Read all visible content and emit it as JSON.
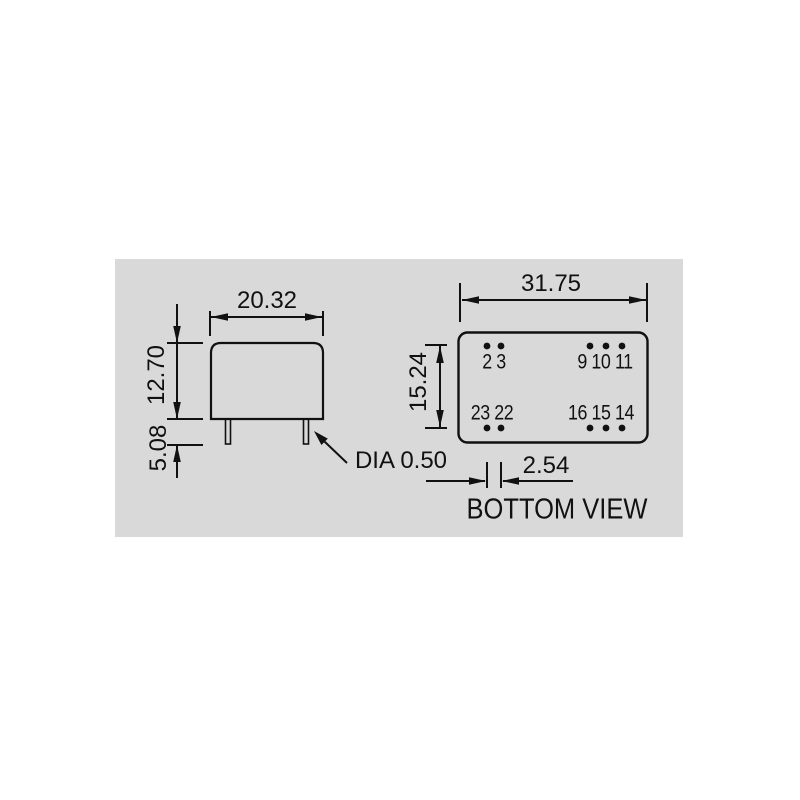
{
  "drawing": {
    "kind": "mechanical-dimension-drawing",
    "units_implied": "mm",
    "colors": {
      "panel_bg": "#d9d9d9",
      "line": "#111111"
    }
  },
  "side_view": {
    "width": "20.32",
    "height": "12.70",
    "pin_length": "5.08",
    "pin_diameter": "DIA 0.50"
  },
  "bottom_view": {
    "width": "31.75",
    "row_spacing": "15.24",
    "pin_pitch": "2.54",
    "caption": "BOTTOM VIEW",
    "pins": {
      "top_left": "2 3",
      "top_right": "9 10 11",
      "bottom_left": "23 22",
      "bottom_right": "16 15 14"
    }
  }
}
